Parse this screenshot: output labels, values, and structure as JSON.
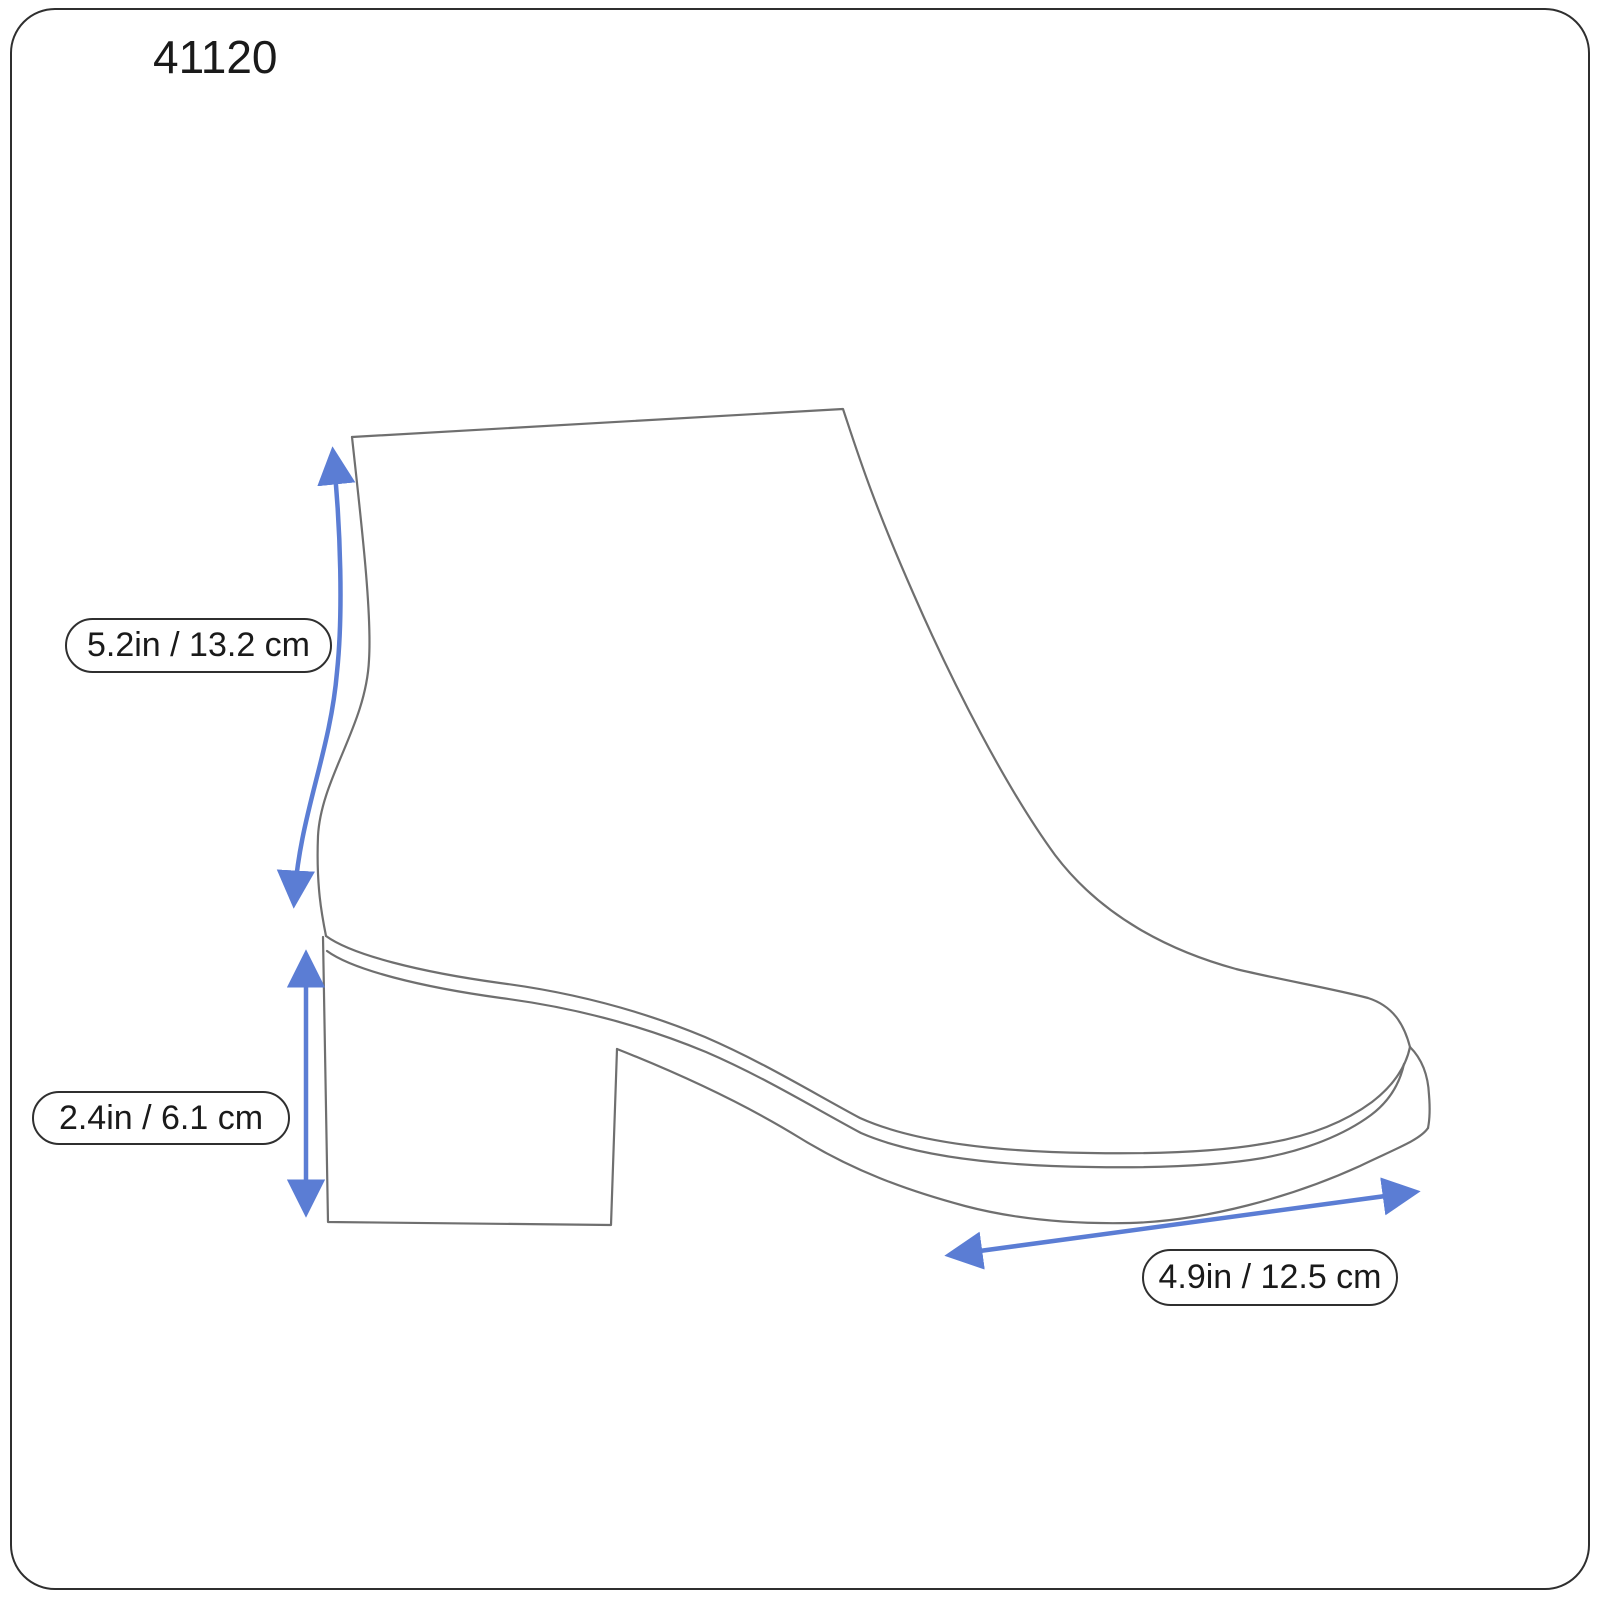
{
  "page": {
    "model_number": "41120"
  },
  "colors": {
    "arrow": "#5b7dd4",
    "outline": "#6f6f6f",
    "text": "#1a1a1a",
    "pill_border": "#2f2f2f",
    "frame": "#2f2f2f",
    "background": "#ffffff"
  },
  "measurements": {
    "shaft_height": {
      "label": "5.2in / 13.2 cm"
    },
    "heel_height": {
      "label": "2.4in / 6.1 cm"
    },
    "sole_length": {
      "label": "4.9in / 12.5 cm"
    }
  },
  "icons": {
    "measurement_arrow": "double-headed-arrow"
  }
}
